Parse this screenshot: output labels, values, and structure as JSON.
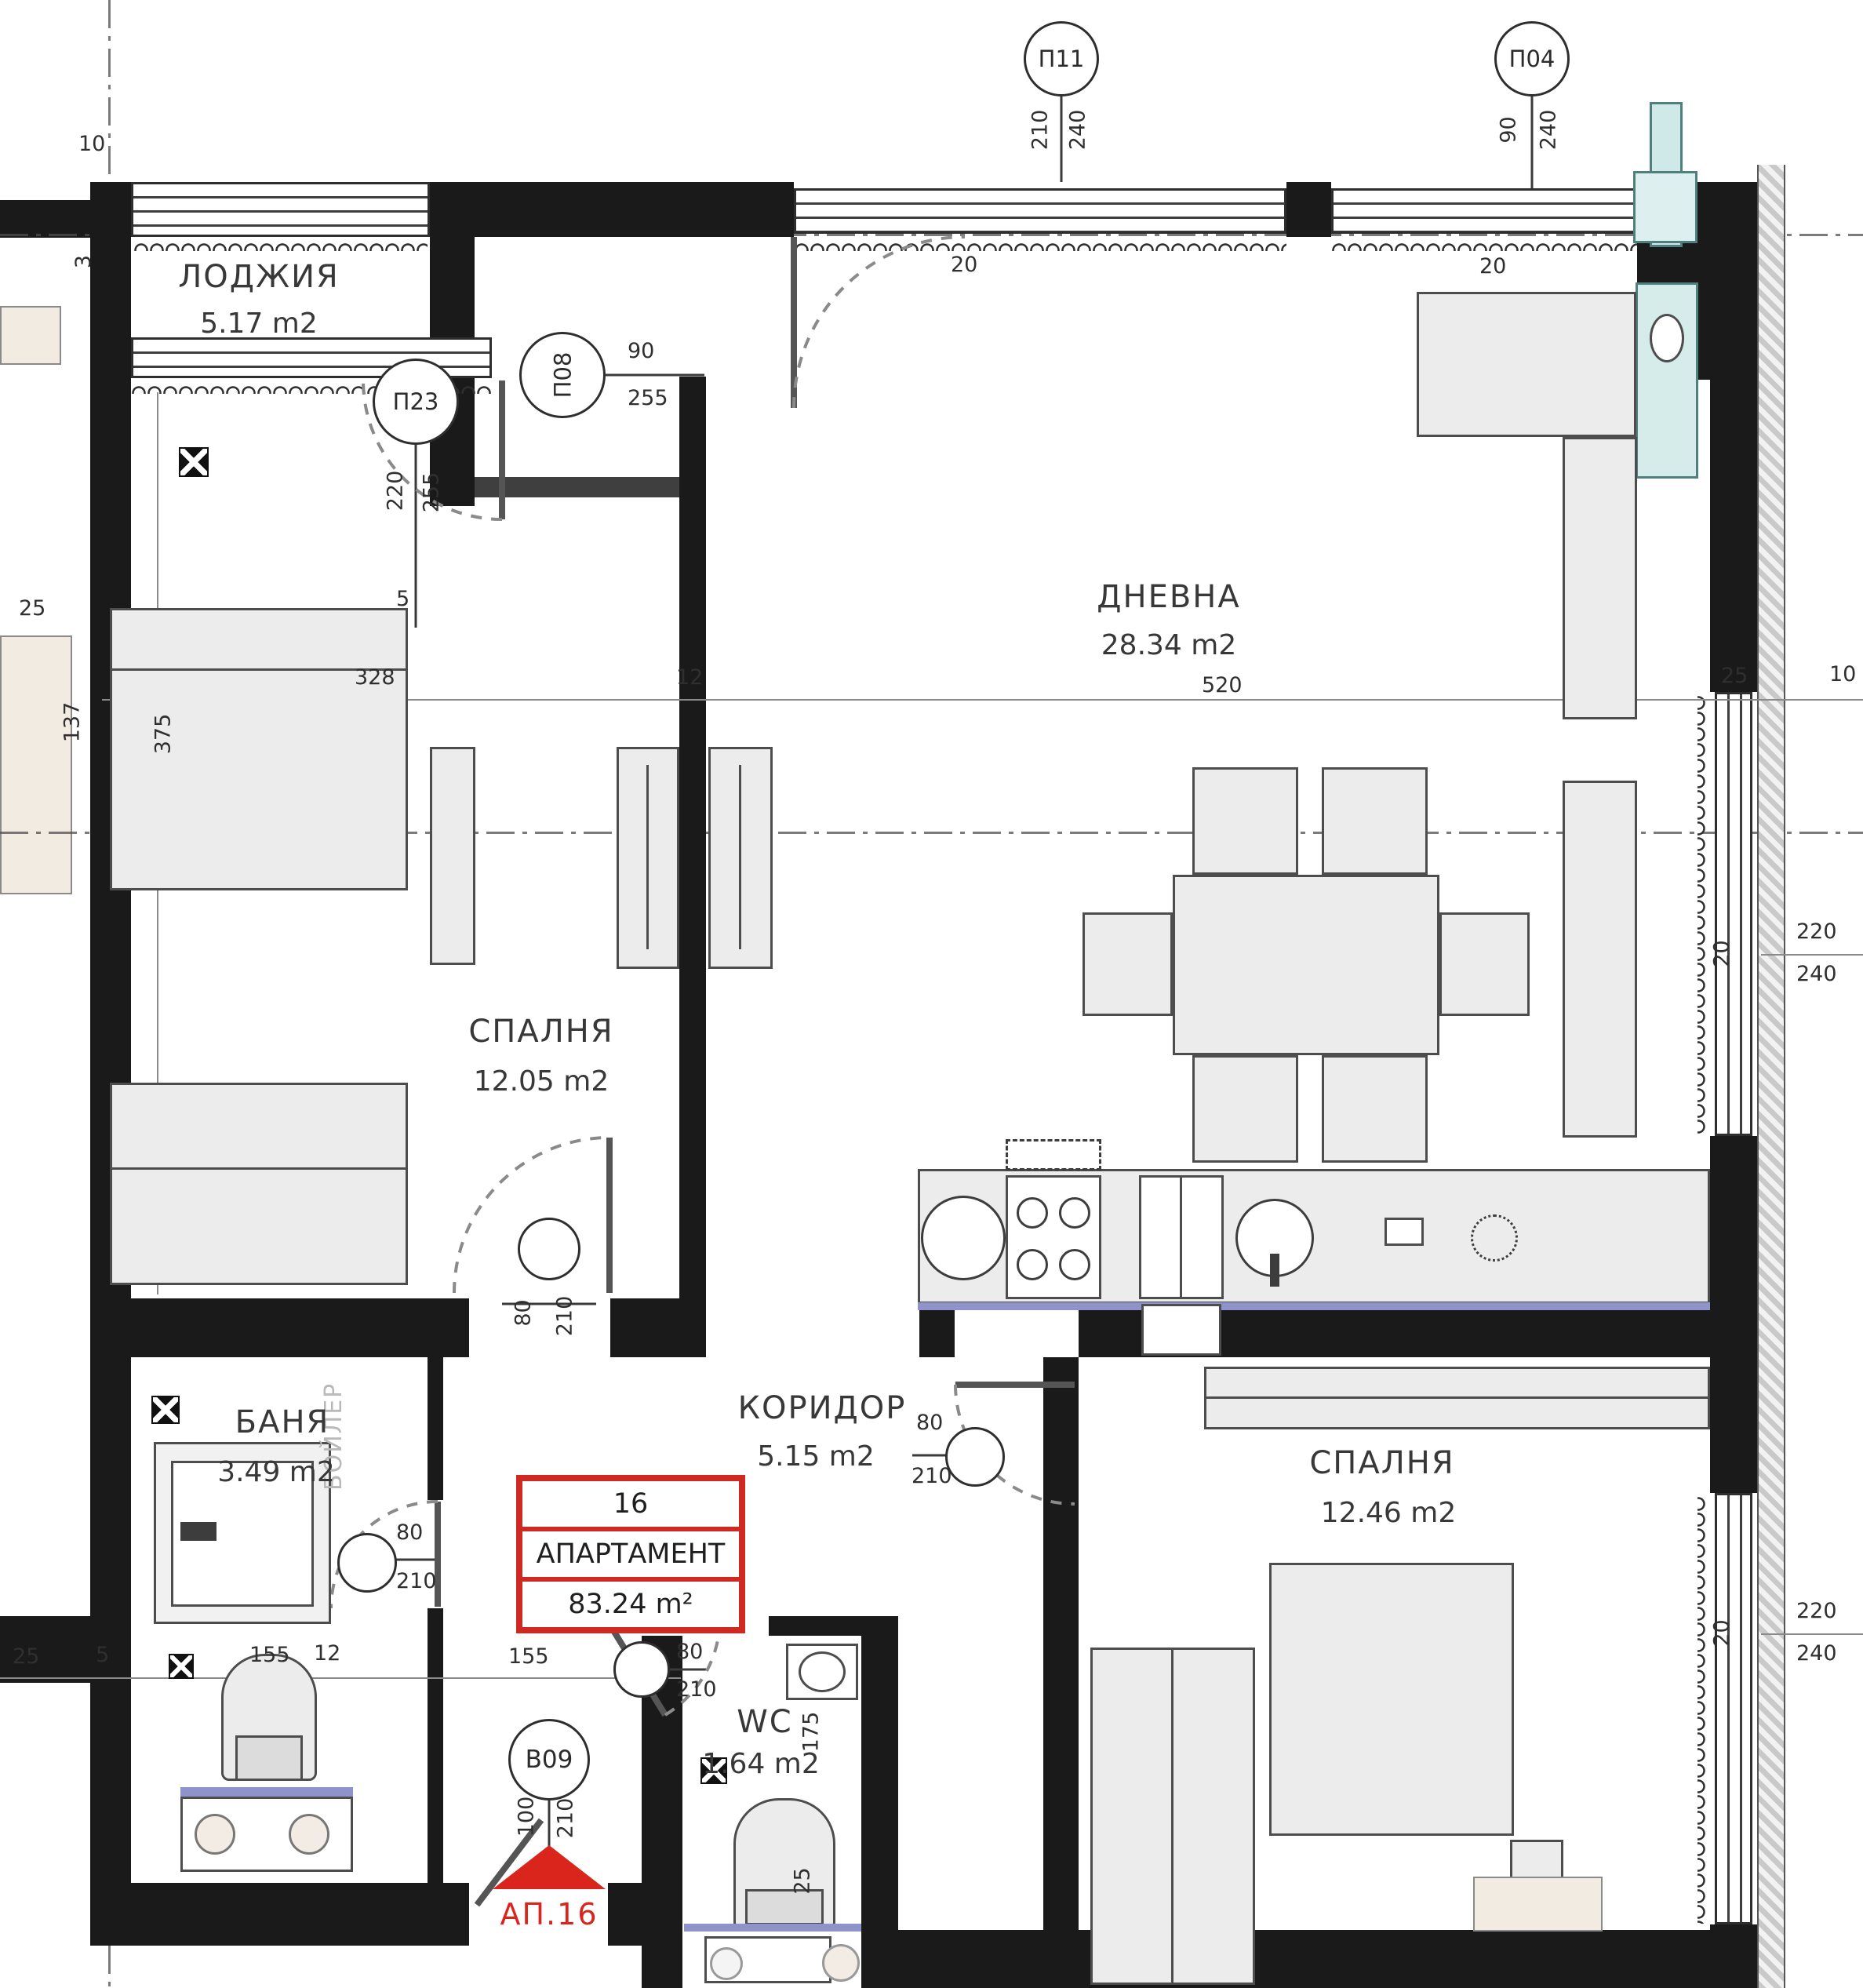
{
  "plan": {
    "rooms": {
      "loggia": {
        "name": "ЛОДЖИЯ",
        "area": "5.17 m2"
      },
      "living": {
        "name": "ДНЕВНА",
        "area": "28.34 m2"
      },
      "bedroom1": {
        "name": "СПАЛНЯ",
        "area": "12.05 m2"
      },
      "bath": {
        "name": "БАНЯ",
        "area": "3.49 m2"
      },
      "corridor": {
        "name": "КОРИДОР",
        "area": "5.15 m2"
      },
      "bedroom2": {
        "name": "СПАЛНЯ",
        "area": "12.46 m2"
      },
      "wc": {
        "name": "WC",
        "area": "1.64 m2"
      }
    },
    "tag": {
      "number": "16",
      "label": "АПАРТАМЕНТ",
      "area": "83.24 m²"
    },
    "entry": {
      "marker": "В09",
      "w": "100",
      "h": "210",
      "label": "АП.16"
    },
    "markers": {
      "p11": {
        "id": "П11",
        "w": "210",
        "h": "240"
      },
      "p04": {
        "id": "П04",
        "w": "90",
        "h": "240"
      },
      "p23": {
        "id": "П23",
        "w": "220",
        "h": "255"
      },
      "p08": {
        "id": "П08",
        "w": "90",
        "h": "255"
      }
    },
    "doors": {
      "w": "80",
      "h": "210"
    },
    "boiler": "БОЙЛЕР",
    "dims": {
      "a10": "10",
      "a3": "3",
      "a137": "137",
      "a375": "375",
      "a25": "25",
      "a328": "328",
      "a12": "12",
      "a520": "520",
      "b25": "25",
      "b10": "10",
      "t20a": "20",
      "t20b": "20",
      "r20a": "20",
      "r220a": "220",
      "r240a": "240",
      "r20b": "20",
      "r220b": "220",
      "r240b": "240",
      "c25": "25",
      "c5": "5",
      "c155a": "155",
      "c12": "12",
      "c155b": "155",
      "v175": "175",
      "v25": "25",
      "s5": "5"
    },
    "colors": {
      "wall": "#1a1a1a",
      "red": "#cf2a21",
      "furniture": "#ececec",
      "teal": "#d5ecea",
      "accent_line": "#8e93c9"
    }
  }
}
